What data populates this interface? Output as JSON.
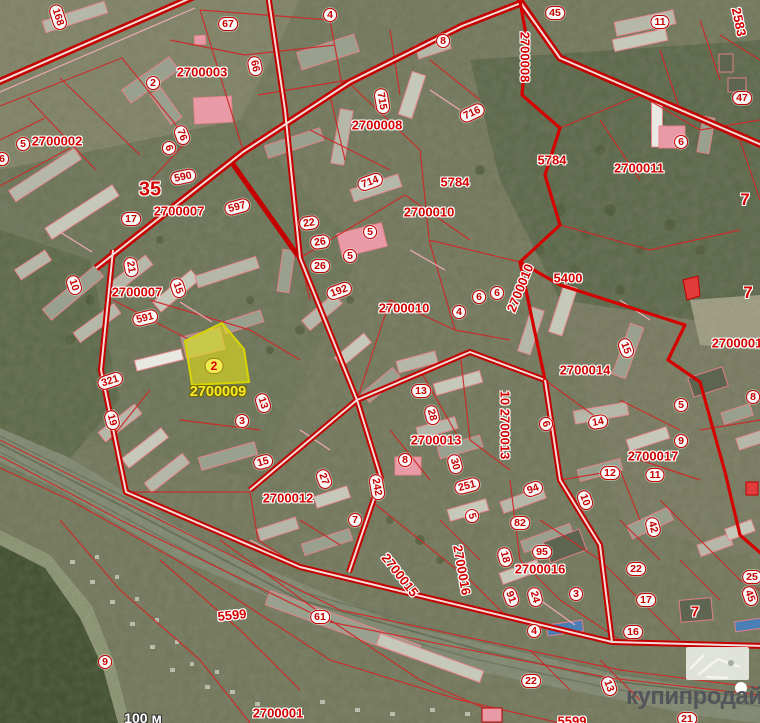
{
  "map": {
    "type": "cadastral-satellite",
    "highlighted_parcel": {
      "badge": "2",
      "quarter_code": "2700009"
    },
    "labels": [
      {
        "t": "2700002",
        "x": 57,
        "y": 141,
        "k": "q"
      },
      {
        "t": "2700003",
        "x": 202,
        "y": 72,
        "k": "q"
      },
      {
        "t": "2700007",
        "x": 179,
        "y": 211,
        "k": "q"
      },
      {
        "t": "2700007",
        "x": 137,
        "y": 292,
        "k": "q"
      },
      {
        "t": "2700008",
        "x": 377,
        "y": 125,
        "k": "q"
      },
      {
        "t": "2700008",
        "x": 525,
        "y": 57,
        "k": "q",
        "r": 90
      },
      {
        "t": "2700010",
        "x": 429,
        "y": 212,
        "k": "q"
      },
      {
        "t": "2700010",
        "x": 404,
        "y": 308,
        "k": "q"
      },
      {
        "t": "2700010",
        "x": 520,
        "y": 288,
        "k": "q",
        "r": -68
      },
      {
        "t": "2700011",
        "x": 639,
        "y": 168,
        "k": "q"
      },
      {
        "t": "2700012",
        "x": 288,
        "y": 498,
        "k": "q"
      },
      {
        "t": "2700013",
        "x": 436,
        "y": 440,
        "k": "q"
      },
      {
        "t": "10 2700013",
        "x": 505,
        "y": 425,
        "k": "q",
        "r": 90
      },
      {
        "t": "2700014",
        "x": 585,
        "y": 370,
        "k": "q"
      },
      {
        "t": "2700015",
        "x": 400,
        "y": 575,
        "k": "q",
        "r": 52
      },
      {
        "t": "2700016",
        "x": 462,
        "y": 570,
        "k": "q",
        "r": 80
      },
      {
        "t": "2700016",
        "x": 540,
        "y": 569,
        "k": "q"
      },
      {
        "t": "2700017",
        "x": 653,
        "y": 456,
        "k": "q"
      },
      {
        "t": "2700001",
        "x": 737,
        "y": 343,
        "k": "q"
      },
      {
        "t": "2700001",
        "x": 278,
        "y": 713,
        "k": "q"
      },
      {
        "t": "5784",
        "x": 455,
        "y": 182,
        "k": "q"
      },
      {
        "t": "5784",
        "x": 552,
        "y": 160,
        "k": "q"
      },
      {
        "t": "5400",
        "x": 568,
        "y": 278,
        "k": "q"
      },
      {
        "t": "5599",
        "x": 232,
        "y": 615,
        "k": "q",
        "r": -6
      },
      {
        "t": "5599",
        "x": 572,
        "y": 721,
        "k": "q"
      },
      {
        "t": "2583",
        "x": 739,
        "y": 22,
        "k": "q",
        "r": 78
      },
      {
        "t": "35",
        "x": 150,
        "y": 190,
        "k": "q",
        "s": 20
      },
      {
        "t": "7",
        "x": 745,
        "y": 200,
        "k": "q",
        "s": 17
      },
      {
        "t": "7",
        "x": 748,
        "y": 293,
        "k": "q",
        "s": 17
      },
      {
        "t": "7",
        "x": 695,
        "y": 612,
        "k": "q",
        "s": 15
      },
      {
        "t": "168",
        "x": 58,
        "y": 17,
        "r": 72
      },
      {
        "t": "67",
        "x": 228,
        "y": 24
      },
      {
        "t": "2",
        "x": 153,
        "y": 83
      },
      {
        "t": "66",
        "x": 255,
        "y": 66,
        "r": 78
      },
      {
        "t": "4",
        "x": 330,
        "y": 15
      },
      {
        "t": "8",
        "x": 443,
        "y": 41
      },
      {
        "t": "715",
        "x": 382,
        "y": 101,
        "r": 80
      },
      {
        "t": "716",
        "x": 472,
        "y": 113,
        "r": -25
      },
      {
        "t": "45",
        "x": 555,
        "y": 13
      },
      {
        "t": "11",
        "x": 660,
        "y": 22
      },
      {
        "t": "47",
        "x": 742,
        "y": 98
      },
      {
        "t": "6",
        "x": 681,
        "y": 142
      },
      {
        "t": "5",
        "x": 23,
        "y": 144
      },
      {
        "t": "6",
        "x": 2,
        "y": 159
      },
      {
        "t": "76",
        "x": 182,
        "y": 135,
        "r": 70
      },
      {
        "t": "6",
        "x": 169,
        "y": 148,
        "r": 70
      },
      {
        "t": "590",
        "x": 183,
        "y": 177,
        "r": -12
      },
      {
        "t": "597",
        "x": 237,
        "y": 207,
        "r": -15
      },
      {
        "t": "17",
        "x": 131,
        "y": 219
      },
      {
        "t": "714",
        "x": 370,
        "y": 182,
        "r": -20
      },
      {
        "t": "22",
        "x": 309,
        "y": 223,
        "r": -8
      },
      {
        "t": "26",
        "x": 320,
        "y": 242,
        "r": -8
      },
      {
        "t": "5",
        "x": 370,
        "y": 232
      },
      {
        "t": "5",
        "x": 350,
        "y": 256
      },
      {
        "t": "26",
        "x": 320,
        "y": 266
      },
      {
        "t": "192",
        "x": 339,
        "y": 291,
        "r": -20
      },
      {
        "t": "6",
        "x": 479,
        "y": 297
      },
      {
        "t": "6",
        "x": 497,
        "y": 293
      },
      {
        "t": "4",
        "x": 459,
        "y": 312
      },
      {
        "t": "10",
        "x": 74,
        "y": 285,
        "r": 72
      },
      {
        "t": "21",
        "x": 131,
        "y": 267,
        "r": 80
      },
      {
        "t": "15",
        "x": 178,
        "y": 288,
        "r": 72
      },
      {
        "t": "591",
        "x": 145,
        "y": 318,
        "r": -14
      },
      {
        "t": "321",
        "x": 110,
        "y": 381,
        "r": -18
      },
      {
        "t": "19",
        "x": 112,
        "y": 420,
        "r": 75
      },
      {
        "t": "3",
        "x": 242,
        "y": 421
      },
      {
        "t": "13",
        "x": 263,
        "y": 403,
        "r": 72
      },
      {
        "t": "13",
        "x": 421,
        "y": 391
      },
      {
        "t": "28",
        "x": 432,
        "y": 415,
        "r": 75
      },
      {
        "t": "8",
        "x": 405,
        "y": 460
      },
      {
        "t": "30",
        "x": 455,
        "y": 464,
        "r": 75
      },
      {
        "t": "251",
        "x": 467,
        "y": 486,
        "r": -15
      },
      {
        "t": "15",
        "x": 263,
        "y": 462,
        "r": -15
      },
      {
        "t": "27",
        "x": 324,
        "y": 479,
        "r": 70
      },
      {
        "t": "242",
        "x": 377,
        "y": 487,
        "r": 80
      },
      {
        "t": "15",
        "x": 626,
        "y": 348,
        "r": 70
      },
      {
        "t": "5",
        "x": 681,
        "y": 405
      },
      {
        "t": "6",
        "x": 546,
        "y": 424,
        "r": 70
      },
      {
        "t": "14",
        "x": 598,
        "y": 422,
        "r": -10
      },
      {
        "t": "9",
        "x": 681,
        "y": 441
      },
      {
        "t": "12",
        "x": 610,
        "y": 473
      },
      {
        "t": "11",
        "x": 655,
        "y": 475
      },
      {
        "t": "10",
        "x": 585,
        "y": 500,
        "r": 70
      },
      {
        "t": "94",
        "x": 533,
        "y": 489,
        "r": -20
      },
      {
        "t": "82",
        "x": 520,
        "y": 523
      },
      {
        "t": "95",
        "x": 542,
        "y": 552
      },
      {
        "t": "18",
        "x": 505,
        "y": 557,
        "r": 75
      },
      {
        "t": "91",
        "x": 511,
        "y": 597,
        "r": 70
      },
      {
        "t": "24",
        "x": 535,
        "y": 597,
        "r": 75
      },
      {
        "t": "3",
        "x": 576,
        "y": 594
      },
      {
        "t": "4",
        "x": 534,
        "y": 631
      },
      {
        "t": "42",
        "x": 653,
        "y": 527,
        "r": 75
      },
      {
        "t": "22",
        "x": 636,
        "y": 569
      },
      {
        "t": "17",
        "x": 646,
        "y": 600
      },
      {
        "t": "16",
        "x": 633,
        "y": 632
      },
      {
        "t": "25",
        "x": 752,
        "y": 577
      },
      {
        "t": "45",
        "x": 750,
        "y": 596,
        "r": 70
      },
      {
        "t": "22",
        "x": 531,
        "y": 681
      },
      {
        "t": "13",
        "x": 609,
        "y": 686,
        "r": 70
      },
      {
        "t": "21",
        "x": 687,
        "y": 719
      },
      {
        "t": "9",
        "x": 105,
        "y": 662
      },
      {
        "t": "61",
        "x": 320,
        "y": 617
      },
      {
        "t": "7",
        "x": 355,
        "y": 520
      },
      {
        "t": "5",
        "x": 472,
        "y": 516,
        "r": 75
      },
      {
        "t": "8",
        "x": 753,
        "y": 397
      },
      {
        "t": "2",
        "x": 214,
        "y": 366,
        "k": "hb"
      },
      {
        "t": "2700009",
        "x": 218,
        "y": 392,
        "k": "hq"
      },
      {
        "t": "100 м",
        "x": 143,
        "y": 718,
        "k": "sc"
      }
    ]
  },
  "watermark": {
    "text": "купипродай"
  }
}
